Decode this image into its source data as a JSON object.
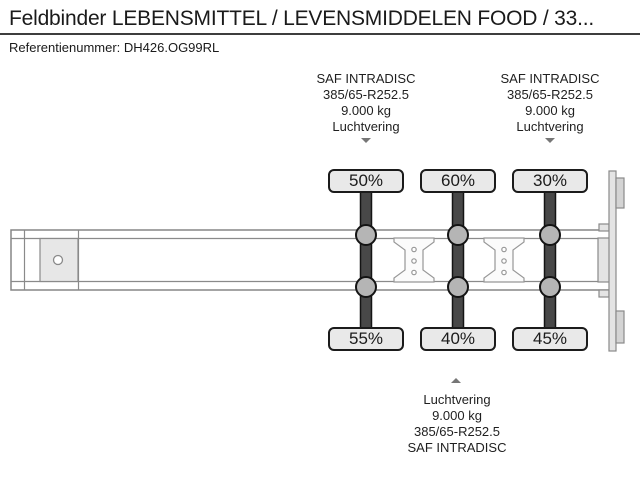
{
  "header": {
    "title": "Feldbinder LEBENSMITTEL / LEVENSMIDDELEN FOOD / 33...",
    "reference": "Referentienummer: DH426.OG99RL"
  },
  "spec_blocks": {
    "axle1_top": [
      "SAF INTRADISC",
      "385/65-R252.5",
      "9.000 kg",
      "Luchtvering"
    ],
    "axle3_top": [
      "SAF INTRADISC",
      "385/65-R252.5",
      "9.000 kg",
      "Luchtvering"
    ],
    "axle2_bottom": [
      "Luchtvering",
      "9.000 kg",
      "385/65-R252.5",
      "SAF INTRADISC"
    ]
  },
  "axle_loads": {
    "top": [
      "50%",
      "60%",
      "30%"
    ],
    "bottom": [
      "55%",
      "40%",
      "45%"
    ]
  },
  "colors": {
    "axle_bar": "#484848",
    "wheel_hub": "#b5b5b5",
    "label_bg": "#e9e9e9",
    "frame_line": "#8a8a8a",
    "text": "#1a1a1a"
  }
}
